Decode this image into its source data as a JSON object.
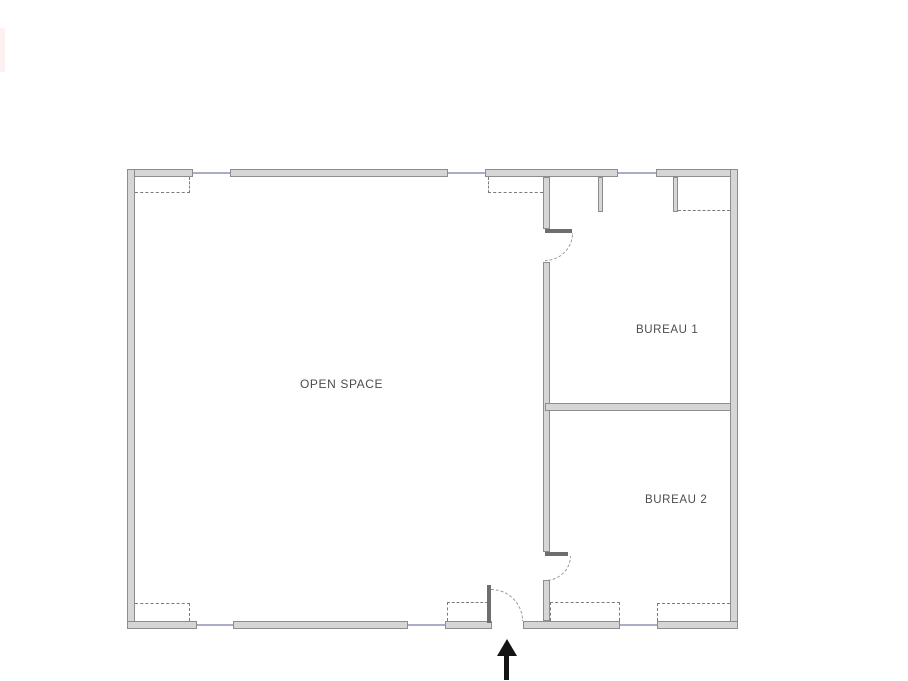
{
  "rooms": [
    {
      "id": "open-space",
      "label": "OPEN SPACE"
    },
    {
      "id": "bureau-1",
      "label": "BUREAU 1"
    },
    {
      "id": "bureau-2",
      "label": "BUREAU 2"
    }
  ],
  "icons": {
    "entrance_arrow": "up-arrow"
  },
  "colors": {
    "bg": "#ffffff",
    "wall_fill": "#d6d6d6",
    "wall_edge": "#8d8d8d",
    "window_line": "#a9aec6",
    "dashed_line": "#7c7c7c",
    "door_panel": "#6e6e6e",
    "door_arc": "#9a9a9a",
    "arrow_color": "#141414",
    "label_color": "#4d4d4d",
    "strip": "#fbeaea"
  }
}
